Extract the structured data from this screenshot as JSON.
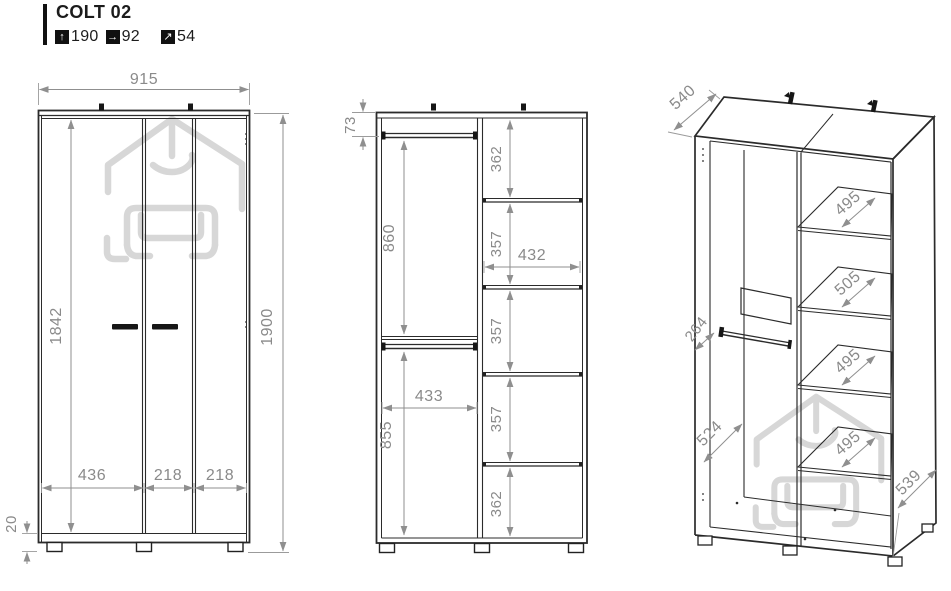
{
  "header": {
    "title": "COLT 02",
    "specs": [
      {
        "icon": "arrow-up",
        "label": "height",
        "value": "190"
      },
      {
        "icon": "arrow-right",
        "label": "width",
        "value": "92"
      },
      {
        "icon": "arrow-up-right",
        "label": "depth",
        "value": "54"
      }
    ]
  },
  "front_view": {
    "width": "915",
    "interior_height": "1842",
    "total_height": "1900",
    "door_widths": [
      "436",
      "218",
      "218"
    ],
    "base_height": "20"
  },
  "interior_view": {
    "top_rod_offset": "73",
    "upper_height": "860",
    "lower_height": "855",
    "lower_rod_width": "433",
    "shelf_width": "432",
    "shelf_spacings": [
      "362",
      "357",
      "357",
      "357",
      "362"
    ]
  },
  "perspective_view": {
    "top_depth": "540",
    "rod_depth": "264",
    "side_depth": "524",
    "bottom_depth": "539",
    "shelf_depths": [
      "495",
      "505",
      "495",
      "495"
    ]
  },
  "colors": {
    "line": "#2b2b2b",
    "dimension": "#8f8f8f",
    "watermark": "#d7d7d7"
  }
}
